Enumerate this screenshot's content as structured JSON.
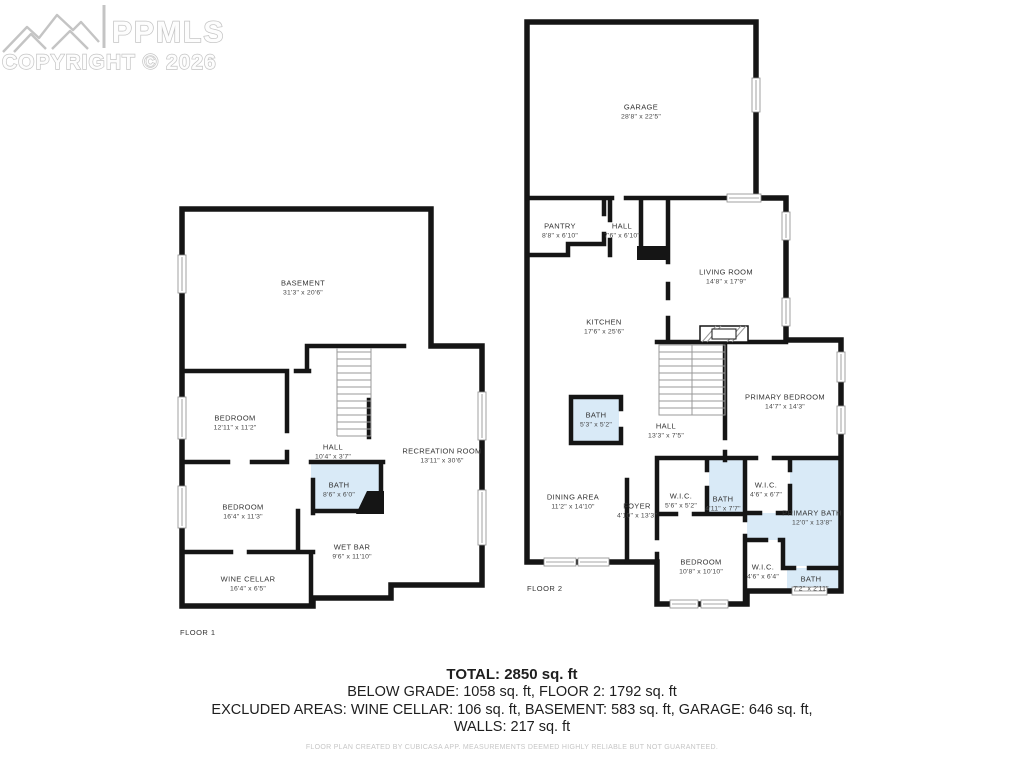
{
  "watermark": {
    "brand": "PPMLS",
    "copyright": "COPYRIGHT © 2026"
  },
  "floor1": {
    "label": "FLOOR 1",
    "rooms": [
      {
        "name": "BASEMENT",
        "dims": "31'3\" x 20'6\""
      },
      {
        "name": "BEDROOM",
        "dims": "12'11\" x 11'2\""
      },
      {
        "name": "HALL",
        "dims": "10'4\" x 3'7\""
      },
      {
        "name": "BATH",
        "dims": "8'6\" x 6'0\""
      },
      {
        "name": "RECREATION ROOM",
        "dims": "13'11\" x 30'6\""
      },
      {
        "name": "BEDROOM",
        "dims": "16'4\" x 11'3\""
      },
      {
        "name": "WET BAR",
        "dims": "9'6\" x 11'10\""
      },
      {
        "name": "WINE CELLAR",
        "dims": "16'4\" x 6'5\""
      }
    ]
  },
  "floor2": {
    "label": "FLOOR 2",
    "rooms": [
      {
        "name": "GARAGE",
        "dims": "28'8\" x 22'5\""
      },
      {
        "name": "PANTRY",
        "dims": "8'8\" x 6'10\""
      },
      {
        "name": "HALL",
        "dims": "7'6\" x 6'10\""
      },
      {
        "name": "LIVING ROOM",
        "dims": "14'8\" x 17'9\""
      },
      {
        "name": "KITCHEN",
        "dims": "17'6\" x 25'6\""
      },
      {
        "name": "PRIMARY BEDROOM",
        "dims": "14'7\" x 14'3\""
      },
      {
        "name": "BATH",
        "dims": "5'3\" x 5'2\""
      },
      {
        "name": "HALL",
        "dims": "13'3\" x 7'5\""
      },
      {
        "name": "DINING AREA",
        "dims": "11'2\" x 14'10\""
      },
      {
        "name": "FOYER",
        "dims": "4'10\" x 13'3\""
      },
      {
        "name": "W.I.C.",
        "dims": "5'6\" x 5'2\""
      },
      {
        "name": "BATH",
        "dims": "4'11\" x 7'7\""
      },
      {
        "name": "W.I.C.",
        "dims": "4'6\" x 6'7\""
      },
      {
        "name": "PRIMARY BATH",
        "dims": "12'0\" x 13'8\""
      },
      {
        "name": "BEDROOM",
        "dims": "10'8\" x 10'10\""
      },
      {
        "name": "W.I.C.",
        "dims": "4'6\" x 6'4\""
      },
      {
        "name": "BATH",
        "dims": "7'2\" x 2'11\""
      }
    ]
  },
  "summary": {
    "total": "TOTAL: 2850 sq. ft",
    "line2": "BELOW GRADE: 1058 sq. ft, FLOOR 2: 1792 sq. ft",
    "line3": "EXCLUDED AREAS: WINE CELLAR: 106 sq. ft, BASEMENT: 583 sq. ft, GARAGE: 646 sq. ft,",
    "line4": "WALLS: 217 sq. ft"
  },
  "disclaimer": "FLOOR PLAN CREATED BY CUBICASA APP. MEASUREMENTS DEEMED HIGHLY RELIABLE BUT NOT GUARANTEED.",
  "colors": {
    "wall": "#151515",
    "bath_fill": "#d9eaf7",
    "watermark": "#c4c4c4"
  }
}
